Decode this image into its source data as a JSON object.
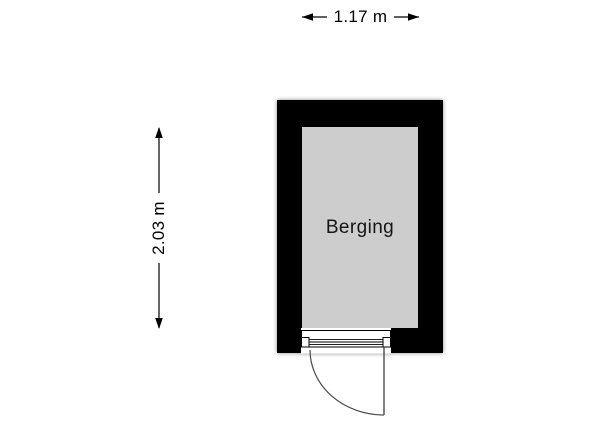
{
  "plan": {
    "room": {
      "label": "Berging"
    },
    "dimensions": {
      "width": {
        "label": "1.17 m"
      },
      "height": {
        "label": "2.03 m"
      }
    },
    "colors": {
      "wall": "#000000",
      "floor": "#cdcdcd",
      "door_line": "#4a4a4a",
      "dimension": "#000000",
      "background": "#ffffff"
    }
  }
}
